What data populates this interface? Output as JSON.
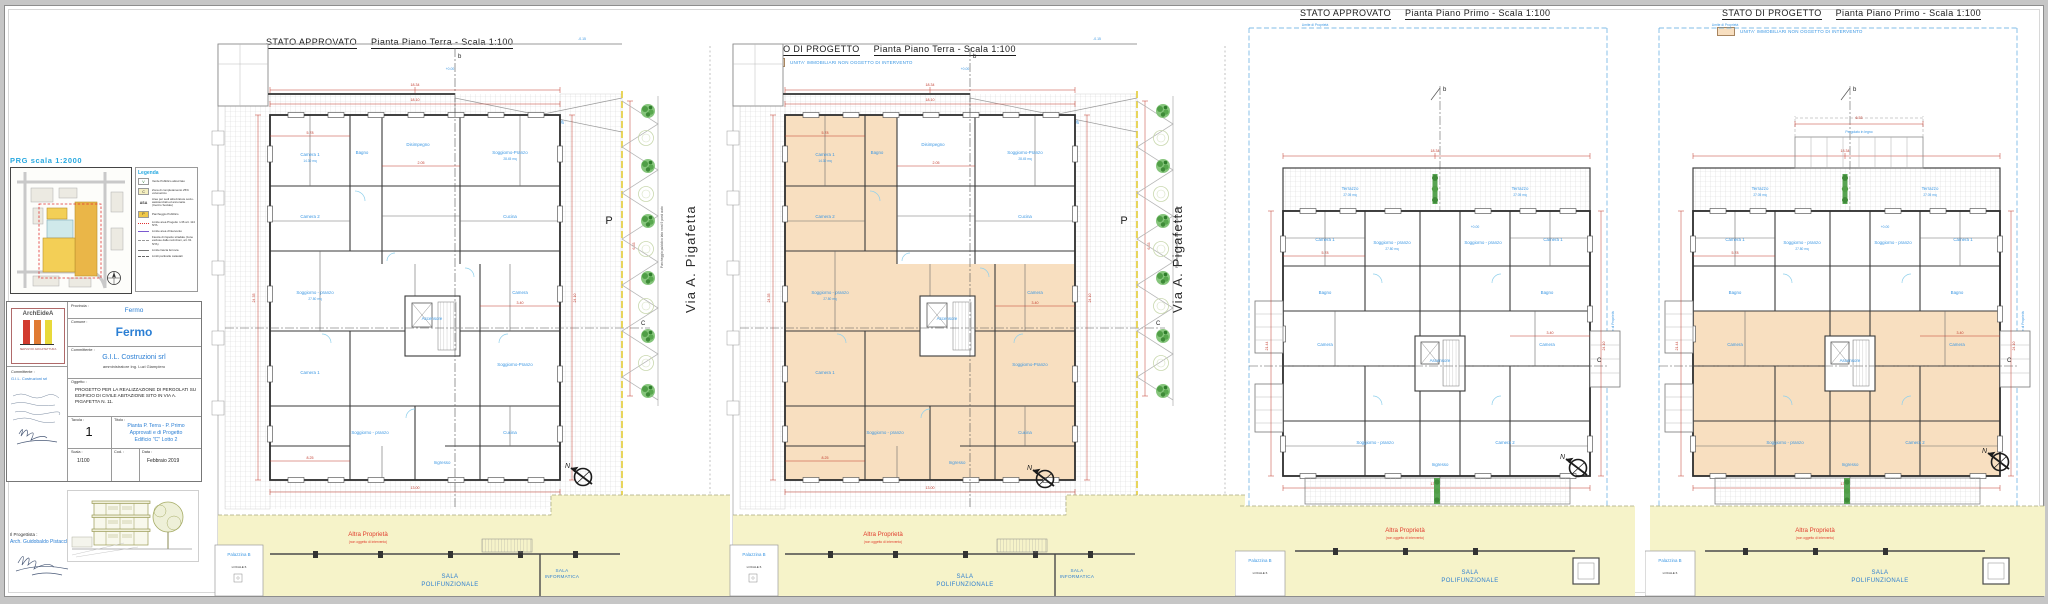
{
  "panels": [
    {
      "state": "STATO APPROVATO",
      "plan": "Pianta Piano Terra - Scala 1:100"
    },
    {
      "state": "STATO DI PROGETTO",
      "plan": "Pianta Piano Terra - Scala 1:100",
      "legend": "UNITA' IMMOBILIARI NON OGGETTO DI INTERVENTO"
    },
    {
      "state": "STATO APPROVATO",
      "plan": "Pianta Piano Primo - Scala 1:100"
    },
    {
      "state": "STATO DI PROGETTO",
      "plan": "Pianta Piano Primo - Scala 1:100",
      "legend": "UNITA' IMMOBILIARI NON OGGETTO DI INTERVENTO"
    }
  ],
  "street": {
    "name": "Via A. Pigafetta"
  },
  "prg": {
    "title": "PRG  scala  1:2000"
  },
  "legenda": {
    "title": "Legenda",
    "items": [
      {
        "key": "V",
        "label": "Verde Pubblico attrezzato"
      },
      {
        "key": "C",
        "label": "Zona di completamento 25% volumetrico"
      },
      {
        "key": "ASA",
        "label": "Aree per sedi attrezzature socio-assistenziali ed annonarie (Centro Sociale)"
      },
      {
        "key": "P",
        "label": "Parcheggio Pubblico"
      },
      {
        "key": "",
        "label": "Limite area Progetto n.36 art. 114 NTA"
      },
      {
        "key": "",
        "label": "Limite area d'intervento"
      },
      {
        "key": "",
        "label": "Fascia di rispetto stradale (zone escluse dalle recinzioni, art. 61 NTA)"
      },
      {
        "key": "",
        "label": "Limite fascia ferrovia"
      },
      {
        "key": "",
        "label": "Limiti particelle catastali"
      }
    ]
  },
  "titleblock": {
    "logo": "ArchEideA",
    "logo_sub": "SERVIZI DI ARCHITETTURA",
    "provincia_label": "Provincia :",
    "provincia": "Fermo",
    "comune_label": "Comune :",
    "comune": "Fermo",
    "committente_label": "Committente :",
    "committente": "G.I.L. Costruzioni srl",
    "committente_sub": "amministratore Ing. Luzi Giampiero",
    "oggetto_label": "Oggetto :",
    "oggetto": "PROGETTO PER LA REALIZZAZIONE DI PERGOLATI SU EDIFICIO DI CIVILE ABITAZIONE SITO IN VIA A. PIGAFETTA N. 11.",
    "tavola_label": "Tavola :",
    "tavola": "1",
    "titolo_label": "Titolo :",
    "titolo1": "Pianta P. Terra - P. Primo",
    "titolo2": "Approvati e di Progetto",
    "titolo3": "Edificio \"C\" Lotto 2",
    "scala_label": "Scala :",
    "scala": "1/100",
    "cod_label": "Cod. :",
    "data_label": "Data :",
    "data": "Febbraio 2019",
    "progettista_label": "Il Progettista :",
    "progettista": "Arch. Guidobaldo Pistacchini"
  },
  "ann": {
    "altra": "Altra Proprietà",
    "altra_sub": "(non oggetto di intervento)",
    "sala_poli_1": "SALA",
    "sala_poli_2": "POLIFUNZIONALE",
    "sala_info_1": "SALA",
    "sala_info_2": "INFORMATICA",
    "palazzina": "Palazzina B",
    "locale": "LOCALE 6",
    "rampa": "Rampa pendenza <= 20%",
    "p": "P",
    "parking_note": "Parcheggio pubblico lato nord 9 posti auto",
    "north": "N",
    "limite": "Limite di Proprietà",
    "sec_b": "b",
    "sec_c": "C",
    "pergolato": "Pergolato in legno",
    "terrazzo": "Terrazzo"
  },
  "rooms": [
    "Camera 1",
    "Camera 2",
    "Soggiorno - pranzo",
    "Cucina",
    "Bagno",
    "Rip.",
    "Disimpegno",
    "Ascensore",
    "Soggiorno-Pranzo",
    "Camera",
    "Ingresso",
    "Studio"
  ],
  "areas": [
    "14.30 mq",
    "28.45 mq",
    "27.80 mq",
    "27.05 mq",
    "4.85 mq",
    "21.44 mq"
  ],
  "dims": [
    "18.34",
    "18.10",
    "24.35",
    "24.10",
    "13.00",
    "6.53",
    "4.53",
    "5.78",
    "2.05",
    "3.40",
    "8.25",
    "1.78",
    "21.44"
  ],
  "elev": [
    "+0.00",
    "-0.15",
    "+98.30"
  ]
}
